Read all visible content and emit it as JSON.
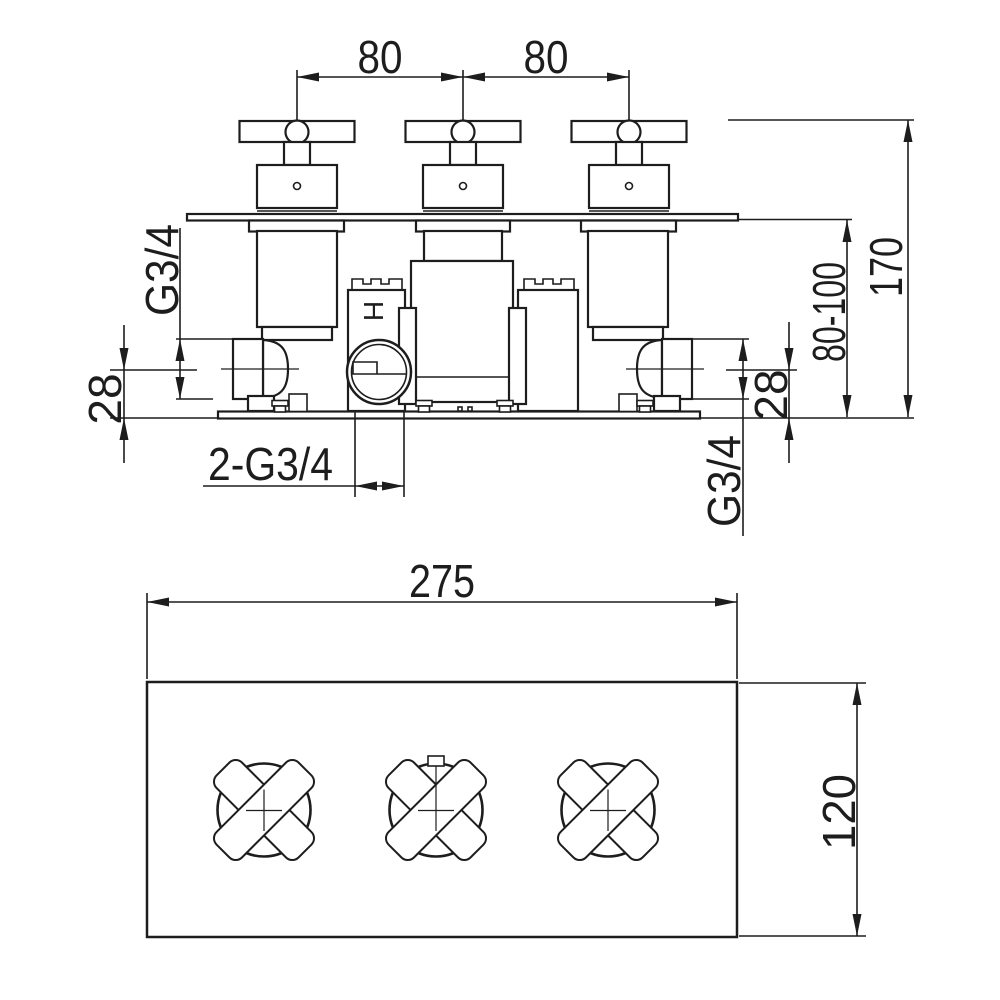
{
  "drawing": {
    "kind": "technical dimension drawing",
    "background_color": "#ffffff",
    "line_color": "#1d1d1d",
    "views": {
      "front": "front elevation of concealed 3-handle thermostatic valve",
      "plan": "plan view of trim plate with 3 cross handles"
    }
  },
  "dimensions": {
    "front": {
      "handle_spacing_left": "80",
      "handle_spacing_right": "80",
      "overall_height": "170",
      "install_depth_range": "80-100",
      "left_inlet_thread": "G3/4",
      "left_inlet_offset": "28",
      "bottom_outlets_thread": "2-G3/4",
      "right_inlet_offset": "28",
      "right_inlet_thread": "G3/4",
      "hot_marking": "H"
    },
    "plan": {
      "plate_width": "275",
      "plate_height": "120"
    }
  }
}
